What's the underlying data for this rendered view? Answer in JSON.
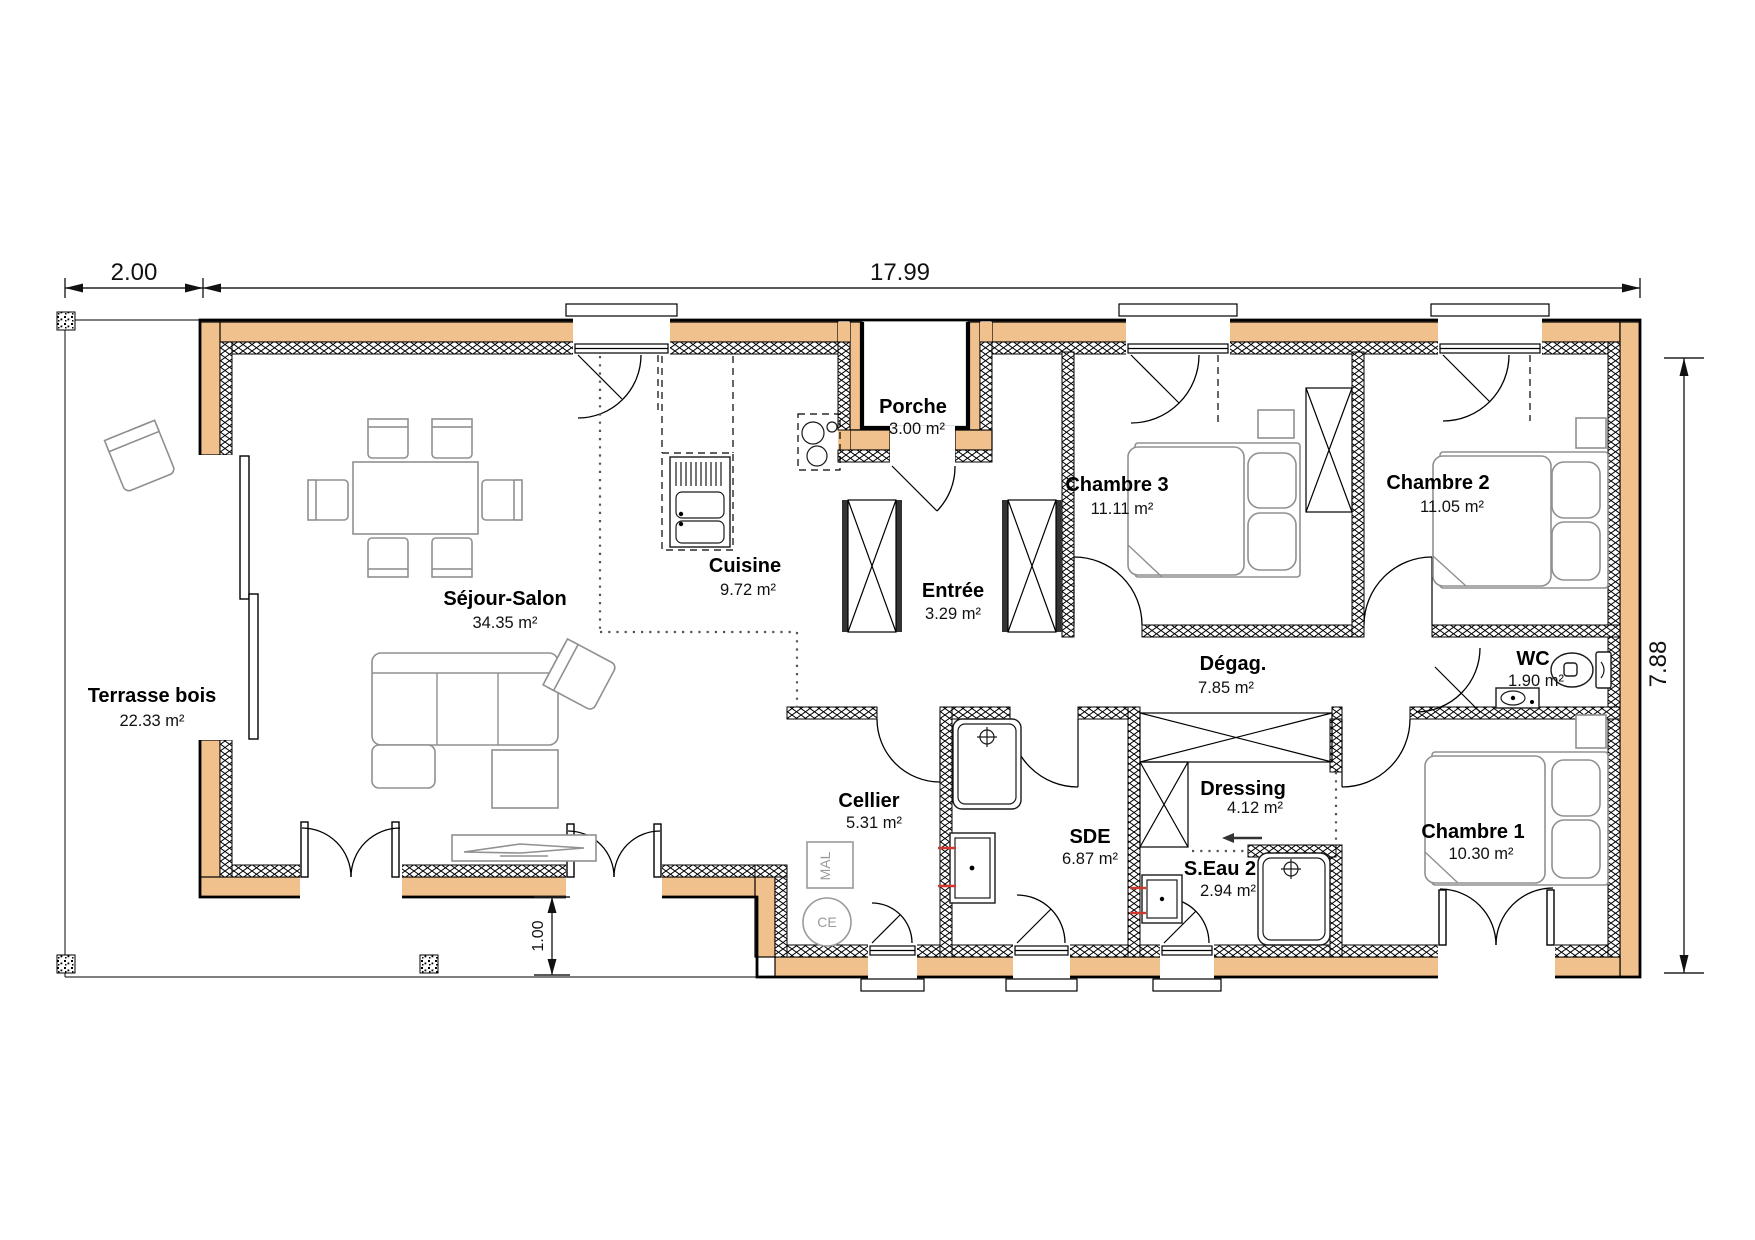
{
  "plan": {
    "dimensions": {
      "terrace_width": "2.00",
      "total_width": "17.99",
      "total_height": "7.88",
      "terrace_overhang": "1.00"
    },
    "rooms": [
      {
        "id": "terrasse",
        "name": "Terrasse bois",
        "area": "22.33 m²"
      },
      {
        "id": "sejour",
        "name": "Séjour-Salon",
        "area": "34.35 m²"
      },
      {
        "id": "cuisine",
        "name": "Cuisine",
        "area": "9.72 m²"
      },
      {
        "id": "porche",
        "name": "Porche",
        "area": "3.00 m²"
      },
      {
        "id": "entree",
        "name": "Entrée",
        "area": "3.29 m²"
      },
      {
        "id": "chambre3",
        "name": "Chambre 3",
        "area": "11.11 m²"
      },
      {
        "id": "chambre2",
        "name": "Chambre 2",
        "area": "11.05 m²"
      },
      {
        "id": "wc",
        "name": "WC",
        "area": "1.90 m²"
      },
      {
        "id": "degag",
        "name": "Dégag.",
        "area": "7.85 m²"
      },
      {
        "id": "cellier",
        "name": "Cellier",
        "area": "5.31 m²"
      },
      {
        "id": "sde",
        "name": "SDE",
        "area": "6.87 m²"
      },
      {
        "id": "dressing",
        "name": "Dressing",
        "area": "4.12 m²"
      },
      {
        "id": "seau2",
        "name": "S.Eau 2",
        "area": "2.94 m²"
      },
      {
        "id": "chambre1",
        "name": "Chambre 1",
        "area": "10.30 m²"
      }
    ],
    "appliances": {
      "washer": "MAL",
      "water_heater": "CE"
    },
    "colors": {
      "wall": "#f0c18d",
      "insulation": "#000000",
      "furniture": "#909090",
      "plumb_mark": "#d03a2e"
    }
  }
}
